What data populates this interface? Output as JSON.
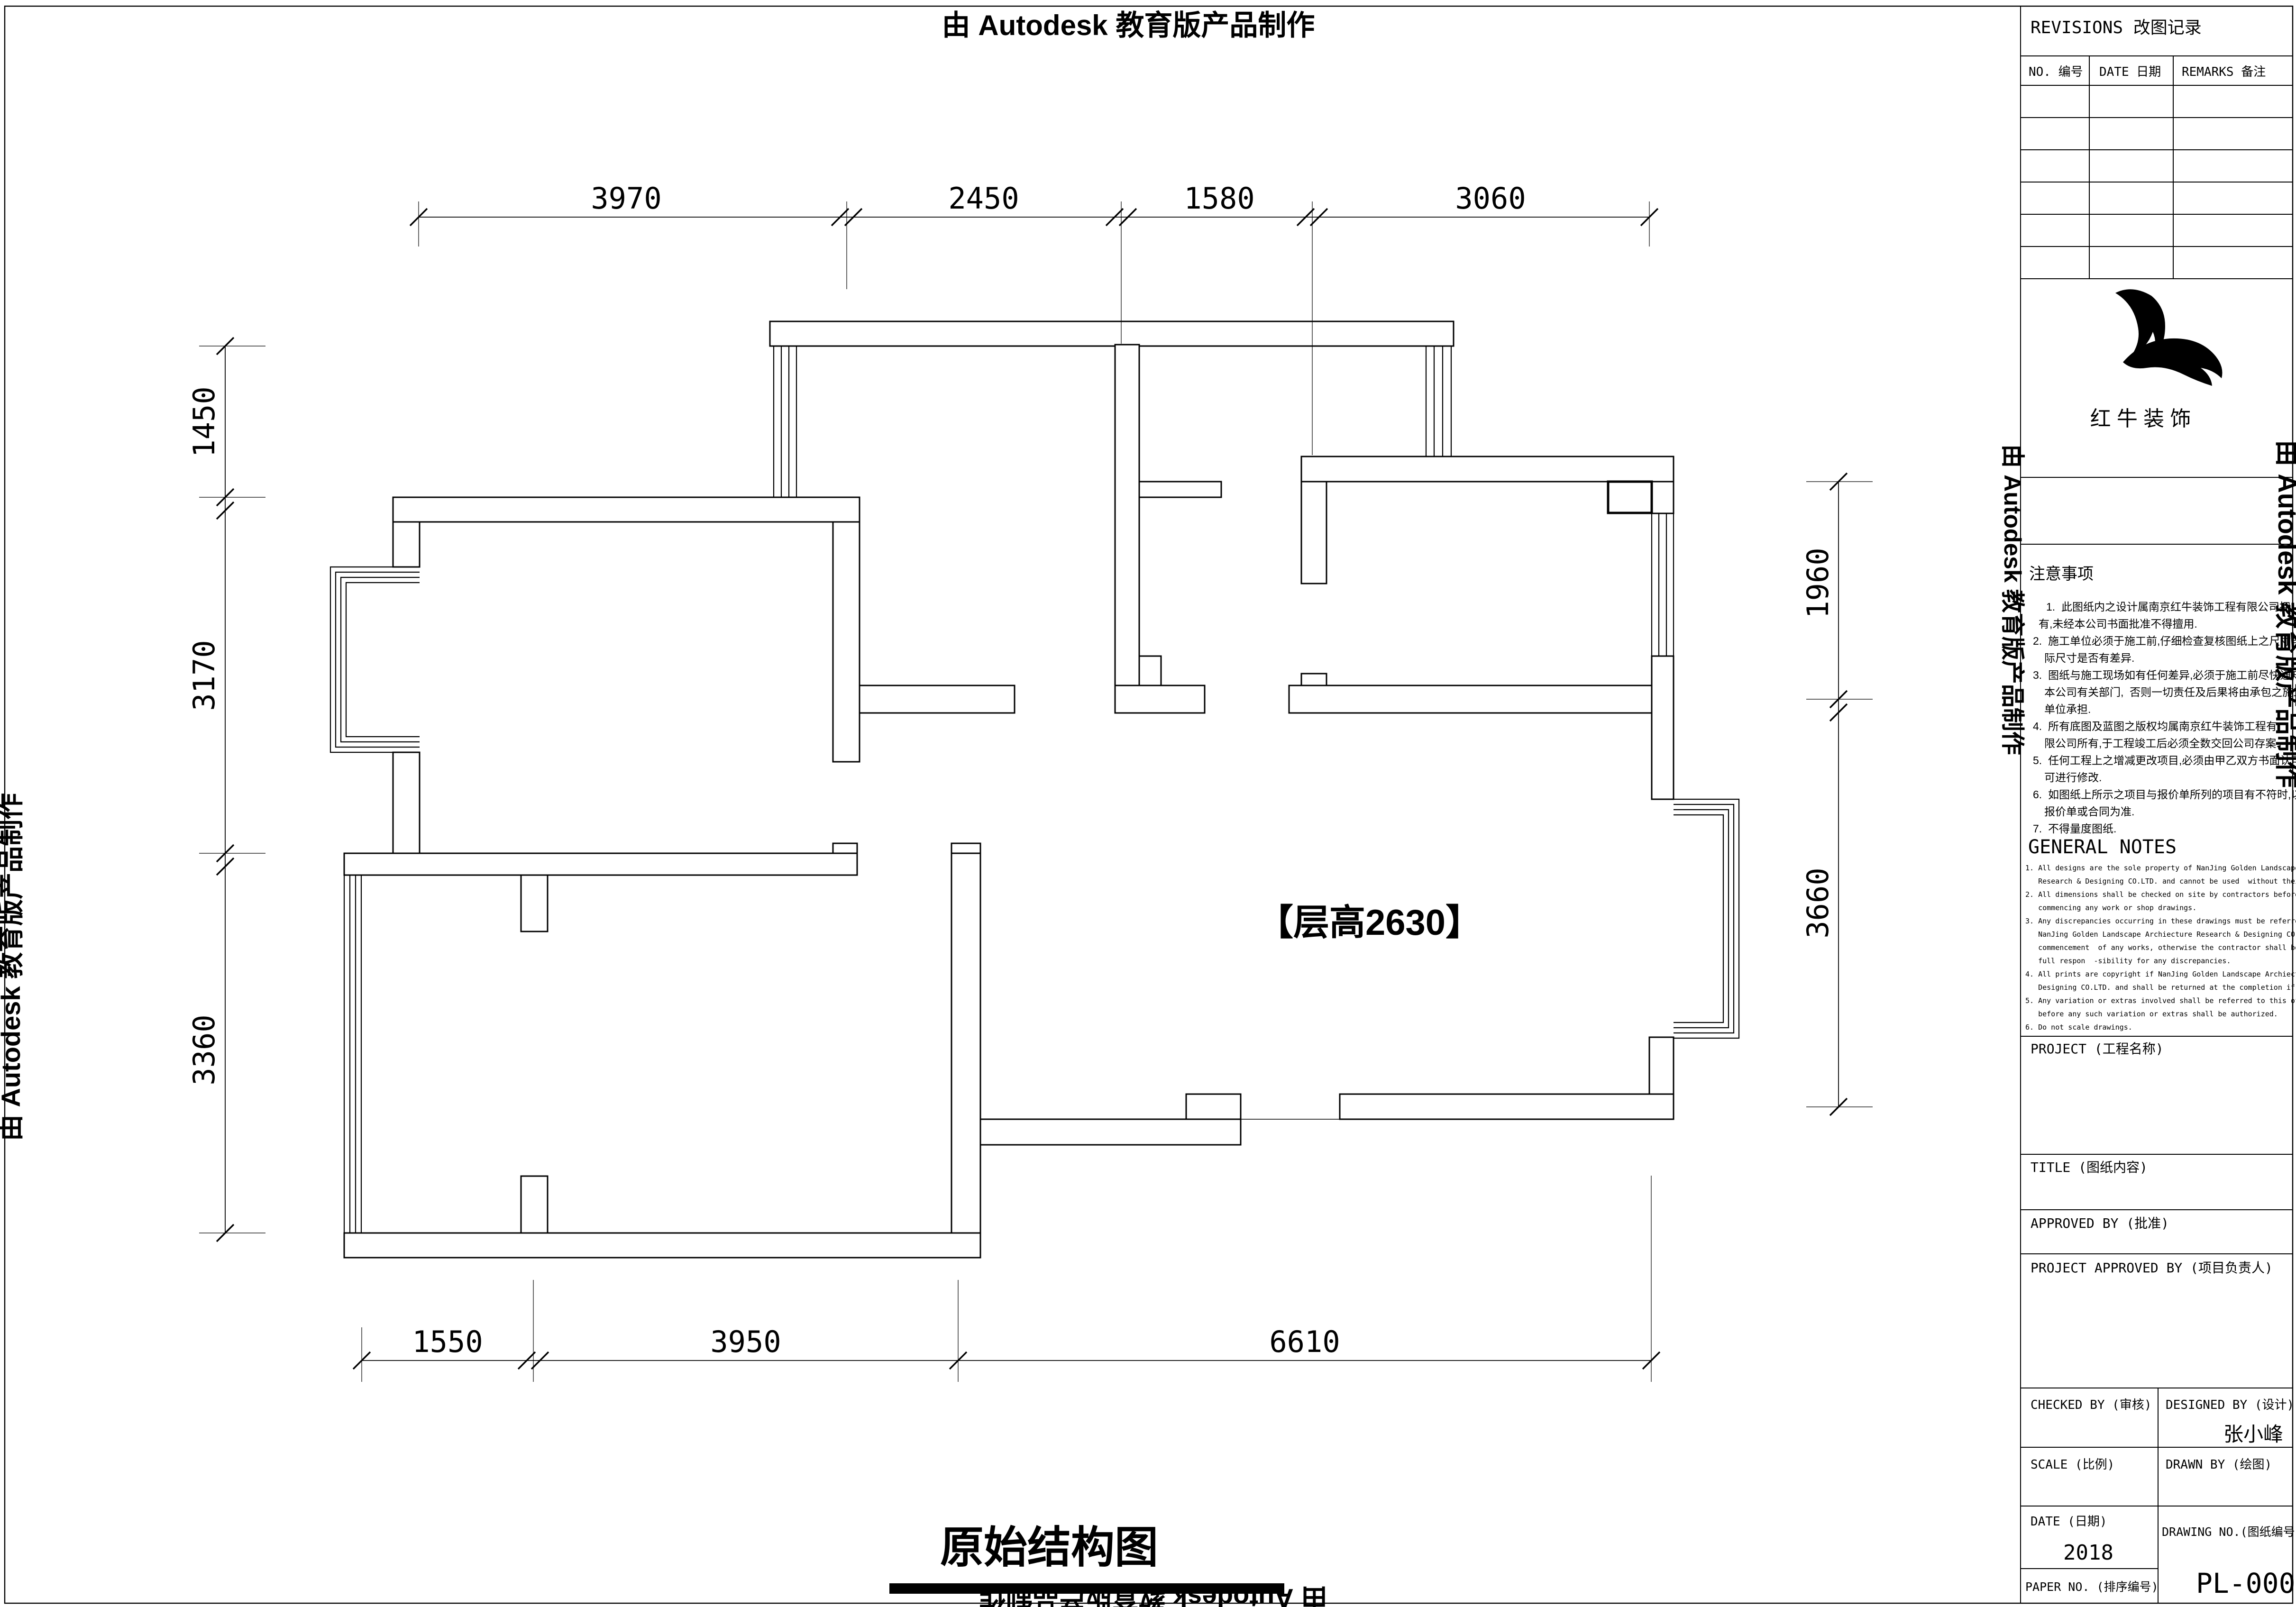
{
  "watermark": {
    "text": "由 Autodesk 教育版产品制作"
  },
  "plan": {
    "floor_height_label": "【层高2630】",
    "drawing_title": "原始结构图"
  },
  "dims": {
    "top": [
      "3970",
      "2450",
      "1580",
      "3060"
    ],
    "left": [
      "1450",
      "3170",
      "3360"
    ],
    "right": [
      "1960",
      "3660"
    ],
    "bottom": [
      "1550",
      "3950",
      "6610"
    ]
  },
  "titleblock": {
    "revisions": {
      "title": "REVISIONS 改图记录",
      "col_no": "NO. 编号",
      "col_date": "DATE 日期",
      "col_remarks": "REMARKS 备注"
    },
    "brand": {
      "name": "红 牛 装 饰"
    },
    "notes_cn": {
      "title": "注意事项",
      "lines": [
        "1.  此图纸内之设计属南京红牛装饰工程有限公司拥",
        "有,未经本公司书面批准不得擅用.",
        "2.  施工单位必须于施工前,仔细检查复核图纸上之尺寸与实",
        "际尺寸是否有差异.",
        "3.  图纸与施工现场如有任何差异,必须于施工前尽快通知",
        "本公司有关部门,  否则一切责任及后果将由承包之施工",
        "单位承担.",
        "4.  所有底图及蓝图之版权均属南京红牛装饰工程有",
        "限公司所有,于工程竣工后必须全数交回公司存案.",
        "5.  任何工程上之增减更改项目,必须由甲乙双方书面认可,",
        "可进行修改.",
        "6.  如图纸上所示之项目与报价单所列的项目有不符时,以",
        "报价单或合同为准.",
        "7.  不得量度图纸."
      ]
    },
    "notes_en": {
      "title": "GENERAL NOTES",
      "lines": [
        "1. All designs are the sole property of NanJing Golden Landscape Archiecture",
        "   Research & Designing CO.LTD. and cannot be used  without their permission.",
        "2. All dimensions shall be checked on site by contractors before",
        "   commencing any work or shop drawings.",
        "3. Any discrepancies occurring in these drawings must be referred to",
        "   NanJing Golden Landscape Archiecture Research & Designing CO.LTD. before",
        "   commencement  of any works, otherwise the contractor shall bear the",
        "   full respon  -sibility for any discrepancies.",
        "4. All prints are copyright if NanJing Golden Landscape Archiecture Research &",
        "   Designing CO.LTD. and shall be returned at the completion if works.",
        "5. Any variation or extras involved shall be referred to this office",
        "   before any such variation or extras shall be authorized.",
        "6. Do not scale drawings."
      ]
    },
    "project_label": "PROJECT (工程名称)",
    "title_label": "TITLE (图纸内容)",
    "approved_label": "APPROVED BY (批准)",
    "project_approved_label": "PROJECT APPROVED BY (项目负责人)",
    "checked_label": "CHECKED BY (审核)",
    "designed_label": "DESIGNED BY (设计)",
    "designer": "张小峰",
    "scale_label": "SCALE (比例)",
    "drawn_label": "DRAWN BY (绘图)",
    "date_label": "DATE (日期)",
    "date_value": "2018",
    "drawing_no_label": "DRAWING NO.(图纸编号)",
    "drawing_no": "PL-000",
    "paper_no_label": "PAPER NO. (排序编号)"
  }
}
